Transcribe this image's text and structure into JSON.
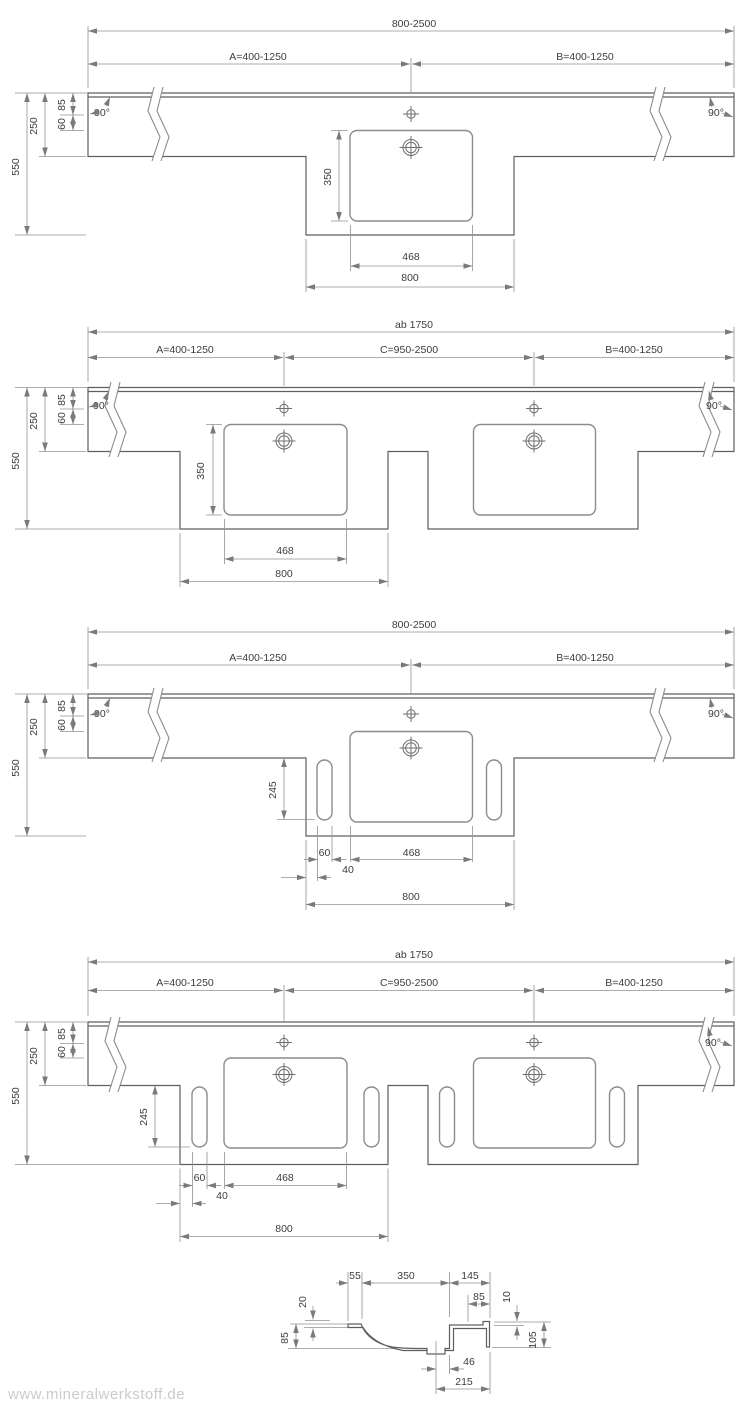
{
  "watermark": "www.mineralwerkstoff.de",
  "colors": {
    "outline": "#5f5f5f",
    "inner": "#8c8c8c",
    "dimension": "#929292",
    "text": "#3d3d3d",
    "watermark": "#cbcbcb"
  },
  "d1": {
    "name": "single-basin-countertop",
    "total": "800-2500",
    "a": "A=400-1250",
    "b": "B=400-1250",
    "angle_left": "90°",
    "angle_right": "90°",
    "d85": "85",
    "d60": "60",
    "d250": "250",
    "d550": "550",
    "d350": "350",
    "d468": "468",
    "d800": "800"
  },
  "d2": {
    "name": "double-basin-countertop",
    "total": "ab 1750",
    "a": "A=400-1250",
    "c": "C=950-2500",
    "b": "B=400-1250",
    "angle_left": "90°",
    "angle_right": "90°",
    "d85": "85",
    "d60": "60",
    "d250": "250",
    "d550": "550",
    "d350": "350",
    "d468": "468",
    "d800": "800"
  },
  "d3": {
    "name": "single-basin-countertop-with-towel-rails",
    "total": "800-2500",
    "a": "A=400-1250",
    "b": "B=400-1250",
    "angle_left": "90°",
    "angle_right": "90°",
    "d85": "85",
    "d60": "60",
    "d250": "250",
    "d550": "550",
    "d245": "245",
    "w60": "60",
    "w40": "40",
    "d468": "468",
    "d800": "800"
  },
  "d4": {
    "name": "double-basin-countertop-with-towel-rails",
    "total": "ab 1750",
    "a": "A=400-1250",
    "c": "C=950-2500",
    "b": "B=400-1250",
    "angle_right": "90°",
    "d85": "85",
    "d60": "60",
    "d250": "250",
    "d550": "550",
    "d245": "245",
    "w60": "60",
    "w40": "40",
    "d468": "468",
    "d800": "800"
  },
  "sec": {
    "name": "basin-cross-section",
    "t55": "55",
    "t350": "350",
    "t145": "145",
    "t85r": "85",
    "t10": "10",
    "t20": "20",
    "t85l": "85",
    "t105": "105",
    "t46": "46",
    "t215": "215"
  }
}
